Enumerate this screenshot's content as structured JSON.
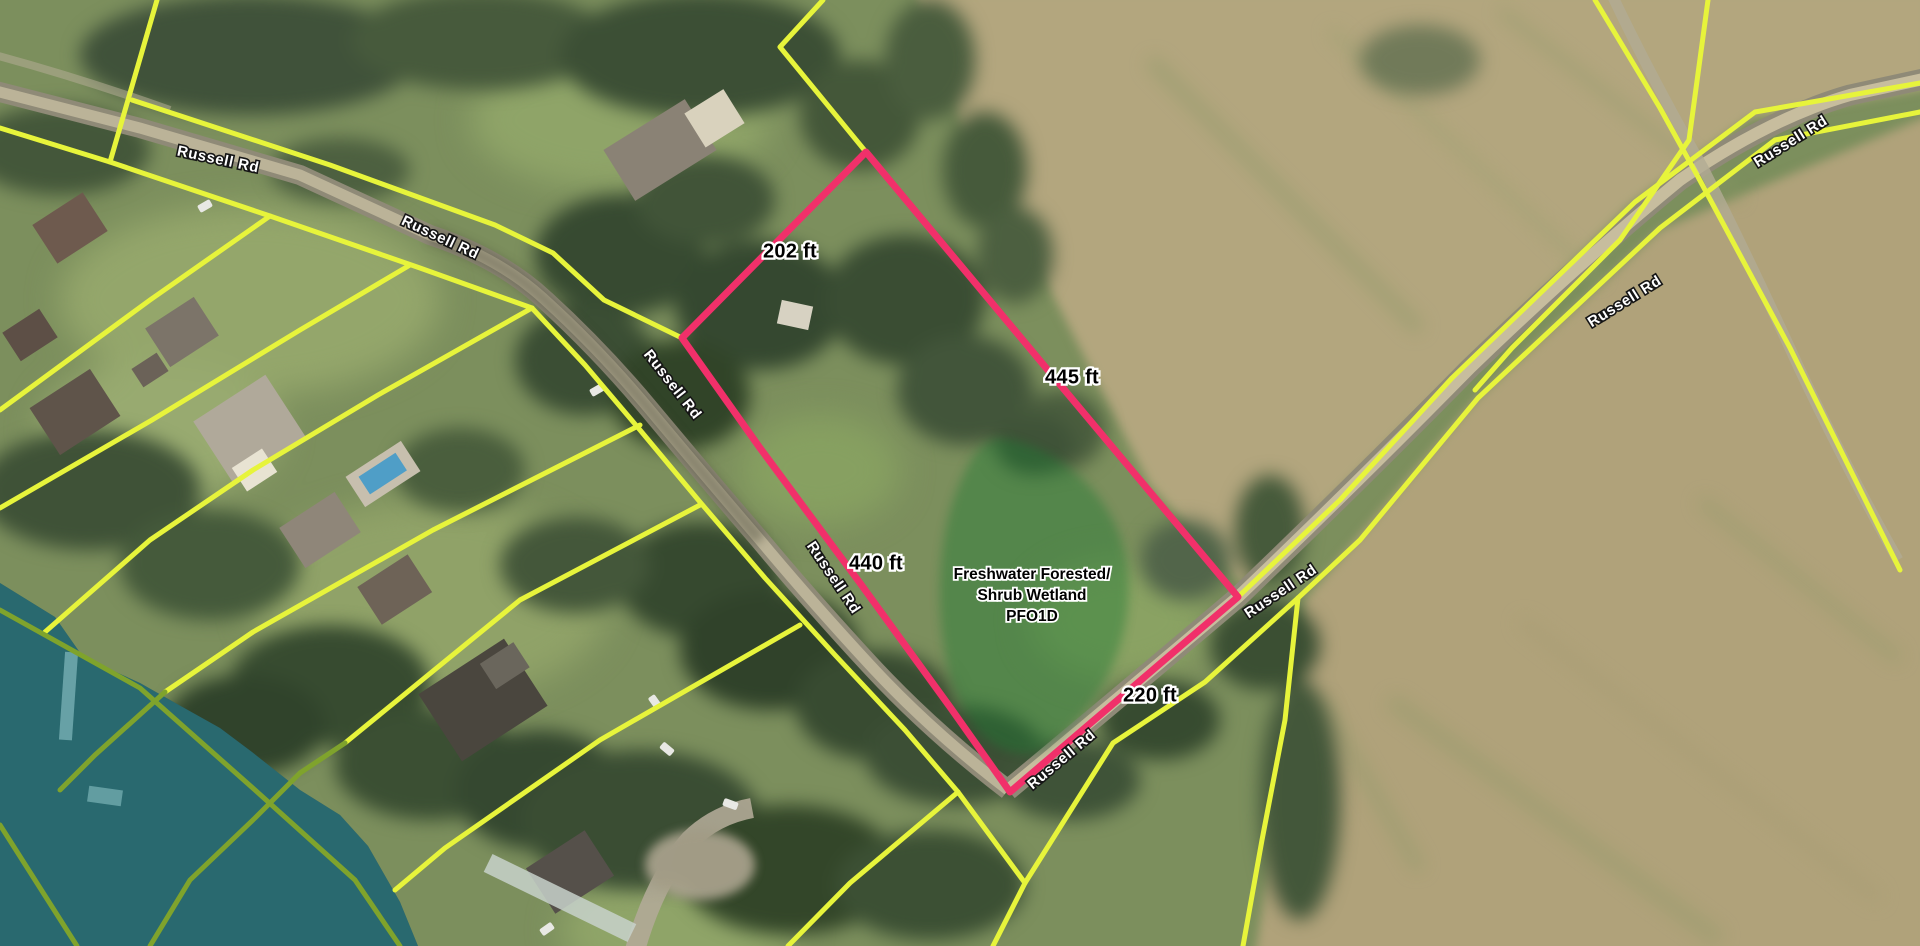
{
  "colors": {
    "parcel_line": "#e7f43b",
    "parcel_line_overwater": "#7fa32c",
    "subject_parcel": "#f1306a",
    "wetland_fill": "#1e7b33",
    "water_overlay": "#16808d",
    "label_halo": "#ffffff",
    "dimension_text": "#000000"
  },
  "roads": {
    "name": "Russell Rd",
    "labels": [
      {
        "text": "Russell Rd"
      },
      {
        "text": "Russell Rd"
      },
      {
        "text": "Russell Rd"
      },
      {
        "text": "Russell Rd"
      },
      {
        "text": "Russell Rd"
      },
      {
        "text": "Russell Rd"
      },
      {
        "text": "Russell Rd"
      },
      {
        "text": "Russell Rd"
      }
    ]
  },
  "subject_parcel": {
    "dimensions": [
      {
        "side": "northwest",
        "label": "202 ft"
      },
      {
        "side": "northeast",
        "label": "445 ft"
      },
      {
        "side": "southwest",
        "label": "440 ft"
      },
      {
        "side": "southeast",
        "label": "220 ft"
      }
    ]
  },
  "wetland": {
    "label_lines": [
      "Freshwater Forested/",
      "Shrub Wetland",
      "PFO1D"
    ],
    "type_code": "PFO1D"
  }
}
